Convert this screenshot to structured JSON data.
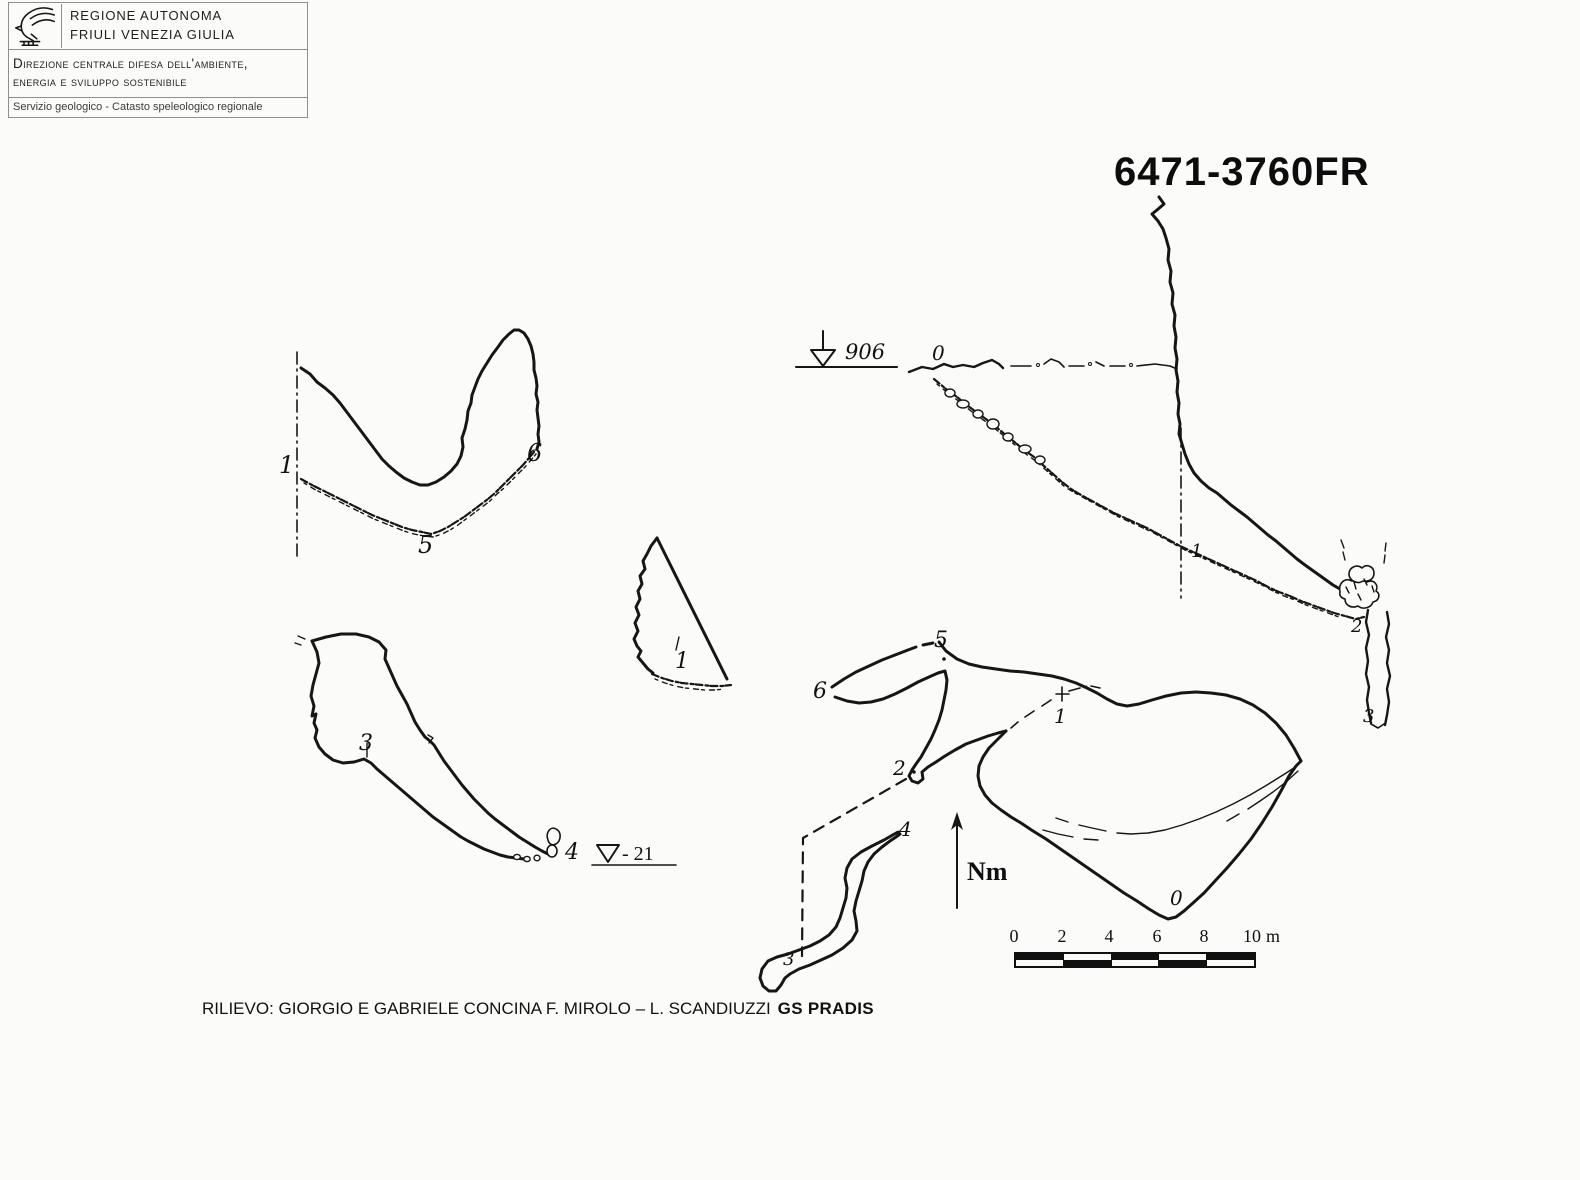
{
  "document": {
    "background": "#fbfbfa",
    "ink": "#161616"
  },
  "header": {
    "logo_icon": "eagle-icon",
    "region_line1": "REGIONE AUTONOMA",
    "region_line2": "FRIULI VENEZIA GIULIA",
    "department_line1": "Direzione centrale difesa dell'ambiente,",
    "department_line2": "energia e sviluppo sostenibile",
    "service_line": "Servizio geologico - Catasto speleologico regionale"
  },
  "title": {
    "cave_code": "6471-3760FR"
  },
  "annotations": {
    "elevation_value": "906",
    "depth_value": "- 21",
    "north_label": "Nm"
  },
  "stations": [
    {
      "area": "cross-section-a",
      "text": "1"
    },
    {
      "area": "cross-section-a",
      "text": "5"
    },
    {
      "area": "cross-section-a",
      "text": "6"
    },
    {
      "area": "cross-section-b",
      "text": "1"
    },
    {
      "area": "plan-west",
      "text": "3"
    },
    {
      "area": "plan-west",
      "text": "4"
    },
    {
      "area": "profile",
      "text": "0"
    },
    {
      "area": "profile",
      "text": "1"
    },
    {
      "area": "profile",
      "text": "2"
    },
    {
      "area": "profile",
      "text": "3"
    },
    {
      "area": "plan-main",
      "text": "5"
    },
    {
      "area": "plan-main",
      "text": "6"
    },
    {
      "area": "plan-main",
      "text": "1"
    },
    {
      "area": "plan-main",
      "text": "2"
    },
    {
      "area": "plan-main",
      "text": "4"
    },
    {
      "area": "plan-main",
      "text": "0"
    },
    {
      "area": "plan-main",
      "text": "3"
    }
  ],
  "scalebar": {
    "ticks": [
      "0",
      "2",
      "4",
      "6",
      "8",
      "10"
    ],
    "unit": "m"
  },
  "credit": {
    "survey_text": "RILIEVO: GIORGIO E GABRIELE CONCINA F. MIROLO – L. SCANDIUZZI",
    "group_name": "GS PRADIS"
  }
}
